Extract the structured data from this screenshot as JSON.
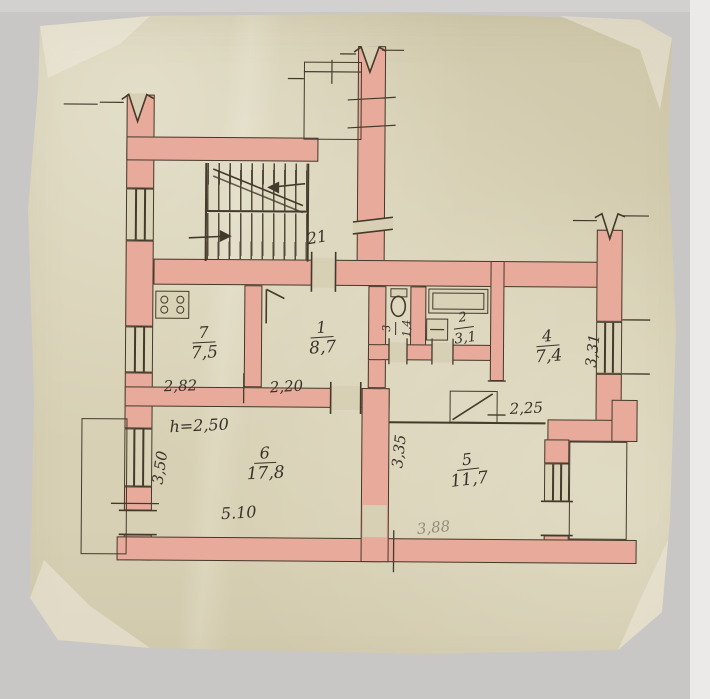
{
  "plan": {
    "apartment_number": "21",
    "rooms": [
      {
        "name": "kitchen",
        "number": "7",
        "area": "7,5"
      },
      {
        "name": "living-room-1",
        "number": "1",
        "area": "8,7"
      },
      {
        "name": "bathroom",
        "number": "2",
        "area": "3,1"
      },
      {
        "name": "wc",
        "number": "3",
        "area": "1,4"
      },
      {
        "name": "room-4",
        "number": "4",
        "area": "7,4"
      },
      {
        "name": "room-6",
        "number": "6",
        "area": "17,8"
      },
      {
        "name": "room-5",
        "number": "5",
        "area": "11,7"
      }
    ],
    "dimensions": {
      "kitchen_width": "2,82",
      "room1_width": "2,20",
      "hall_width": "2,25",
      "ceiling_height": "h=2,50",
      "room6_depth": "3,50",
      "room6_width": "5.10",
      "room5_depth": "3,35",
      "room4_depth": "3,31",
      "room5_width": "3,88"
    },
    "icons": [
      "stove-icon",
      "toilet-icon",
      "bathtub-icon",
      "sink-icon",
      "stairs-up-arrow-icon",
      "stairs-down-arrow-icon"
    ],
    "colors": {
      "wall_fill": "#e8ab9b",
      "ink": "#443a2b",
      "paper": "#d7d0b4",
      "handwriting": "#39322a"
    }
  }
}
